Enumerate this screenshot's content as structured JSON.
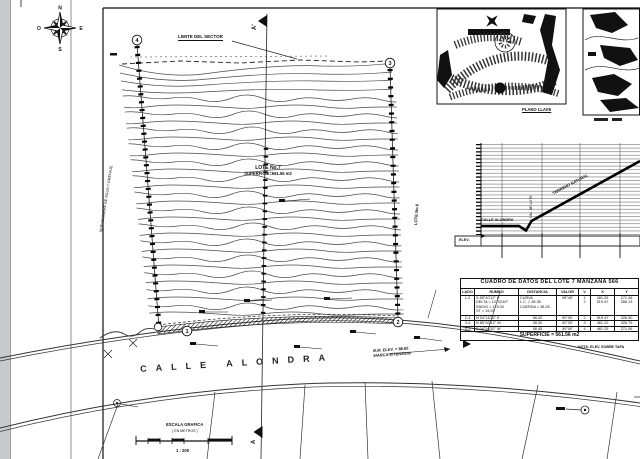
{
  "compass": {
    "north": "N",
    "east": "E",
    "south": "S",
    "west": "O"
  },
  "plan": {
    "limite_sector": "LIMITE DEL SECTOR",
    "section_top": "A'",
    "section_bottom": "A",
    "lote_title": "LOTE No.7",
    "lote_area": "SUPERFICIE=561.56 m2",
    "servidumbre": "SERVIDUMBRE DE AGUA Y DRENAJE",
    "lote_vecino": "LOTE No.6",
    "calle": "CALLE ALONDRA",
    "bm_line1": "B.M. ELEV. = 98.65",
    "bm_line2": "MARCA S/TENSION",
    "vertex_1": "1",
    "vertex_2": "2",
    "vertex_3": "3",
    "vertex_4": "4"
  },
  "escala": {
    "title": "ESCALA GRAFICA",
    "units": "( EN METROS )",
    "ratio": "1 : 200"
  },
  "insets": {
    "plano_llave_caption": "PLANO LLAVE"
  },
  "profile": {
    "label_calle": "CALLE ALONDRA",
    "label_terreno": "TERRENO NATURAL",
    "label_limite": "LIM. DE LOTE",
    "label_box": "ELEV."
  },
  "table": {
    "title": "CUADRO DE DATOS DEL LOTE 7 MANZANA 566",
    "headers": [
      "LADO",
      "RUMBO",
      "DISTANCIA",
      "VALOR",
      "V",
      "X",
      "Y"
    ],
    "rows": [
      [
        "1-2",
        "S 85°40'12\" E\nDELTA = 12°33'40\"\nRADIO = 175.00\nST = 19.25",
        "CURVA\nL.C. = 38.36\nCUERDA = 38.28",
        "98°45'",
        "1\n2",
        "481.25\n519.47",
        "271.06\n268.13"
      ],
      [
        "2-3",
        "N 04°16'32\" E",
        "56.42",
        "90°00'",
        "2",
        "519.47",
        "326.50"
      ],
      [
        "3-4",
        "N 85°40'12\" W",
        "38.30",
        "90°00'",
        "3",
        "481.20",
        "326.75"
      ],
      [
        "4-1",
        "S 04°16'32\" W",
        "56.45",
        "90°00'",
        "4",
        "481.25",
        "271.06"
      ]
    ],
    "footer": "SUPERFICIE = 561.56 m2",
    "note": "NOTA: ELEV. SOBRE TAPA"
  }
}
